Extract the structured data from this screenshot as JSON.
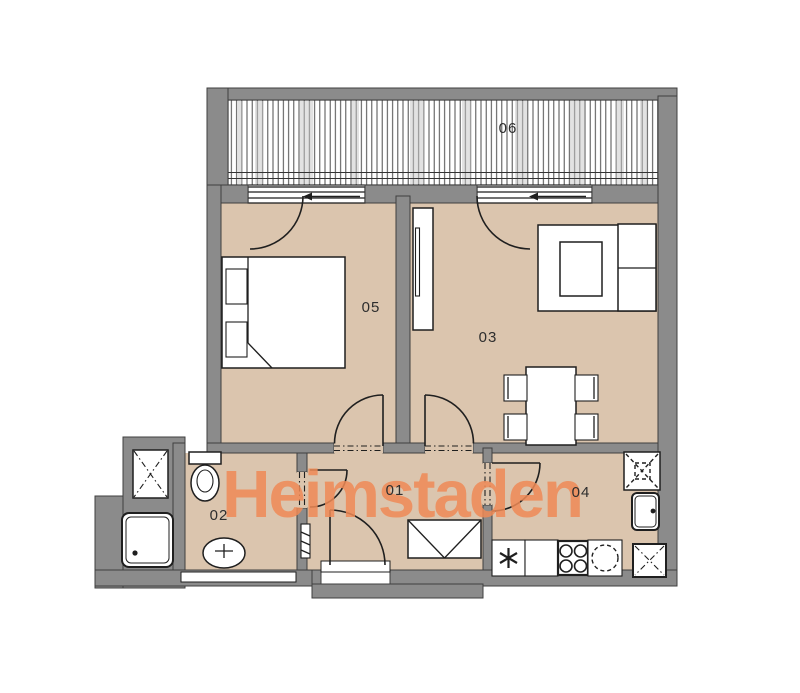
{
  "plan": {
    "watermark": {
      "text": "Heimstaden",
      "color": "#ef8a56"
    },
    "colors": {
      "floor": "#dbc5ae",
      "wall": "#8b8b8b",
      "outline": "#1f1f1f",
      "furniture": "#ffffff",
      "label_text": "#2e2e2e"
    },
    "rooms": {
      "hallway": {
        "label": "01"
      },
      "bathroom": {
        "label": "02"
      },
      "living_room": {
        "label": "03"
      },
      "kitchen": {
        "label": "04"
      },
      "bedroom": {
        "label": "05"
      },
      "balcony": {
        "label": "06"
      }
    }
  }
}
